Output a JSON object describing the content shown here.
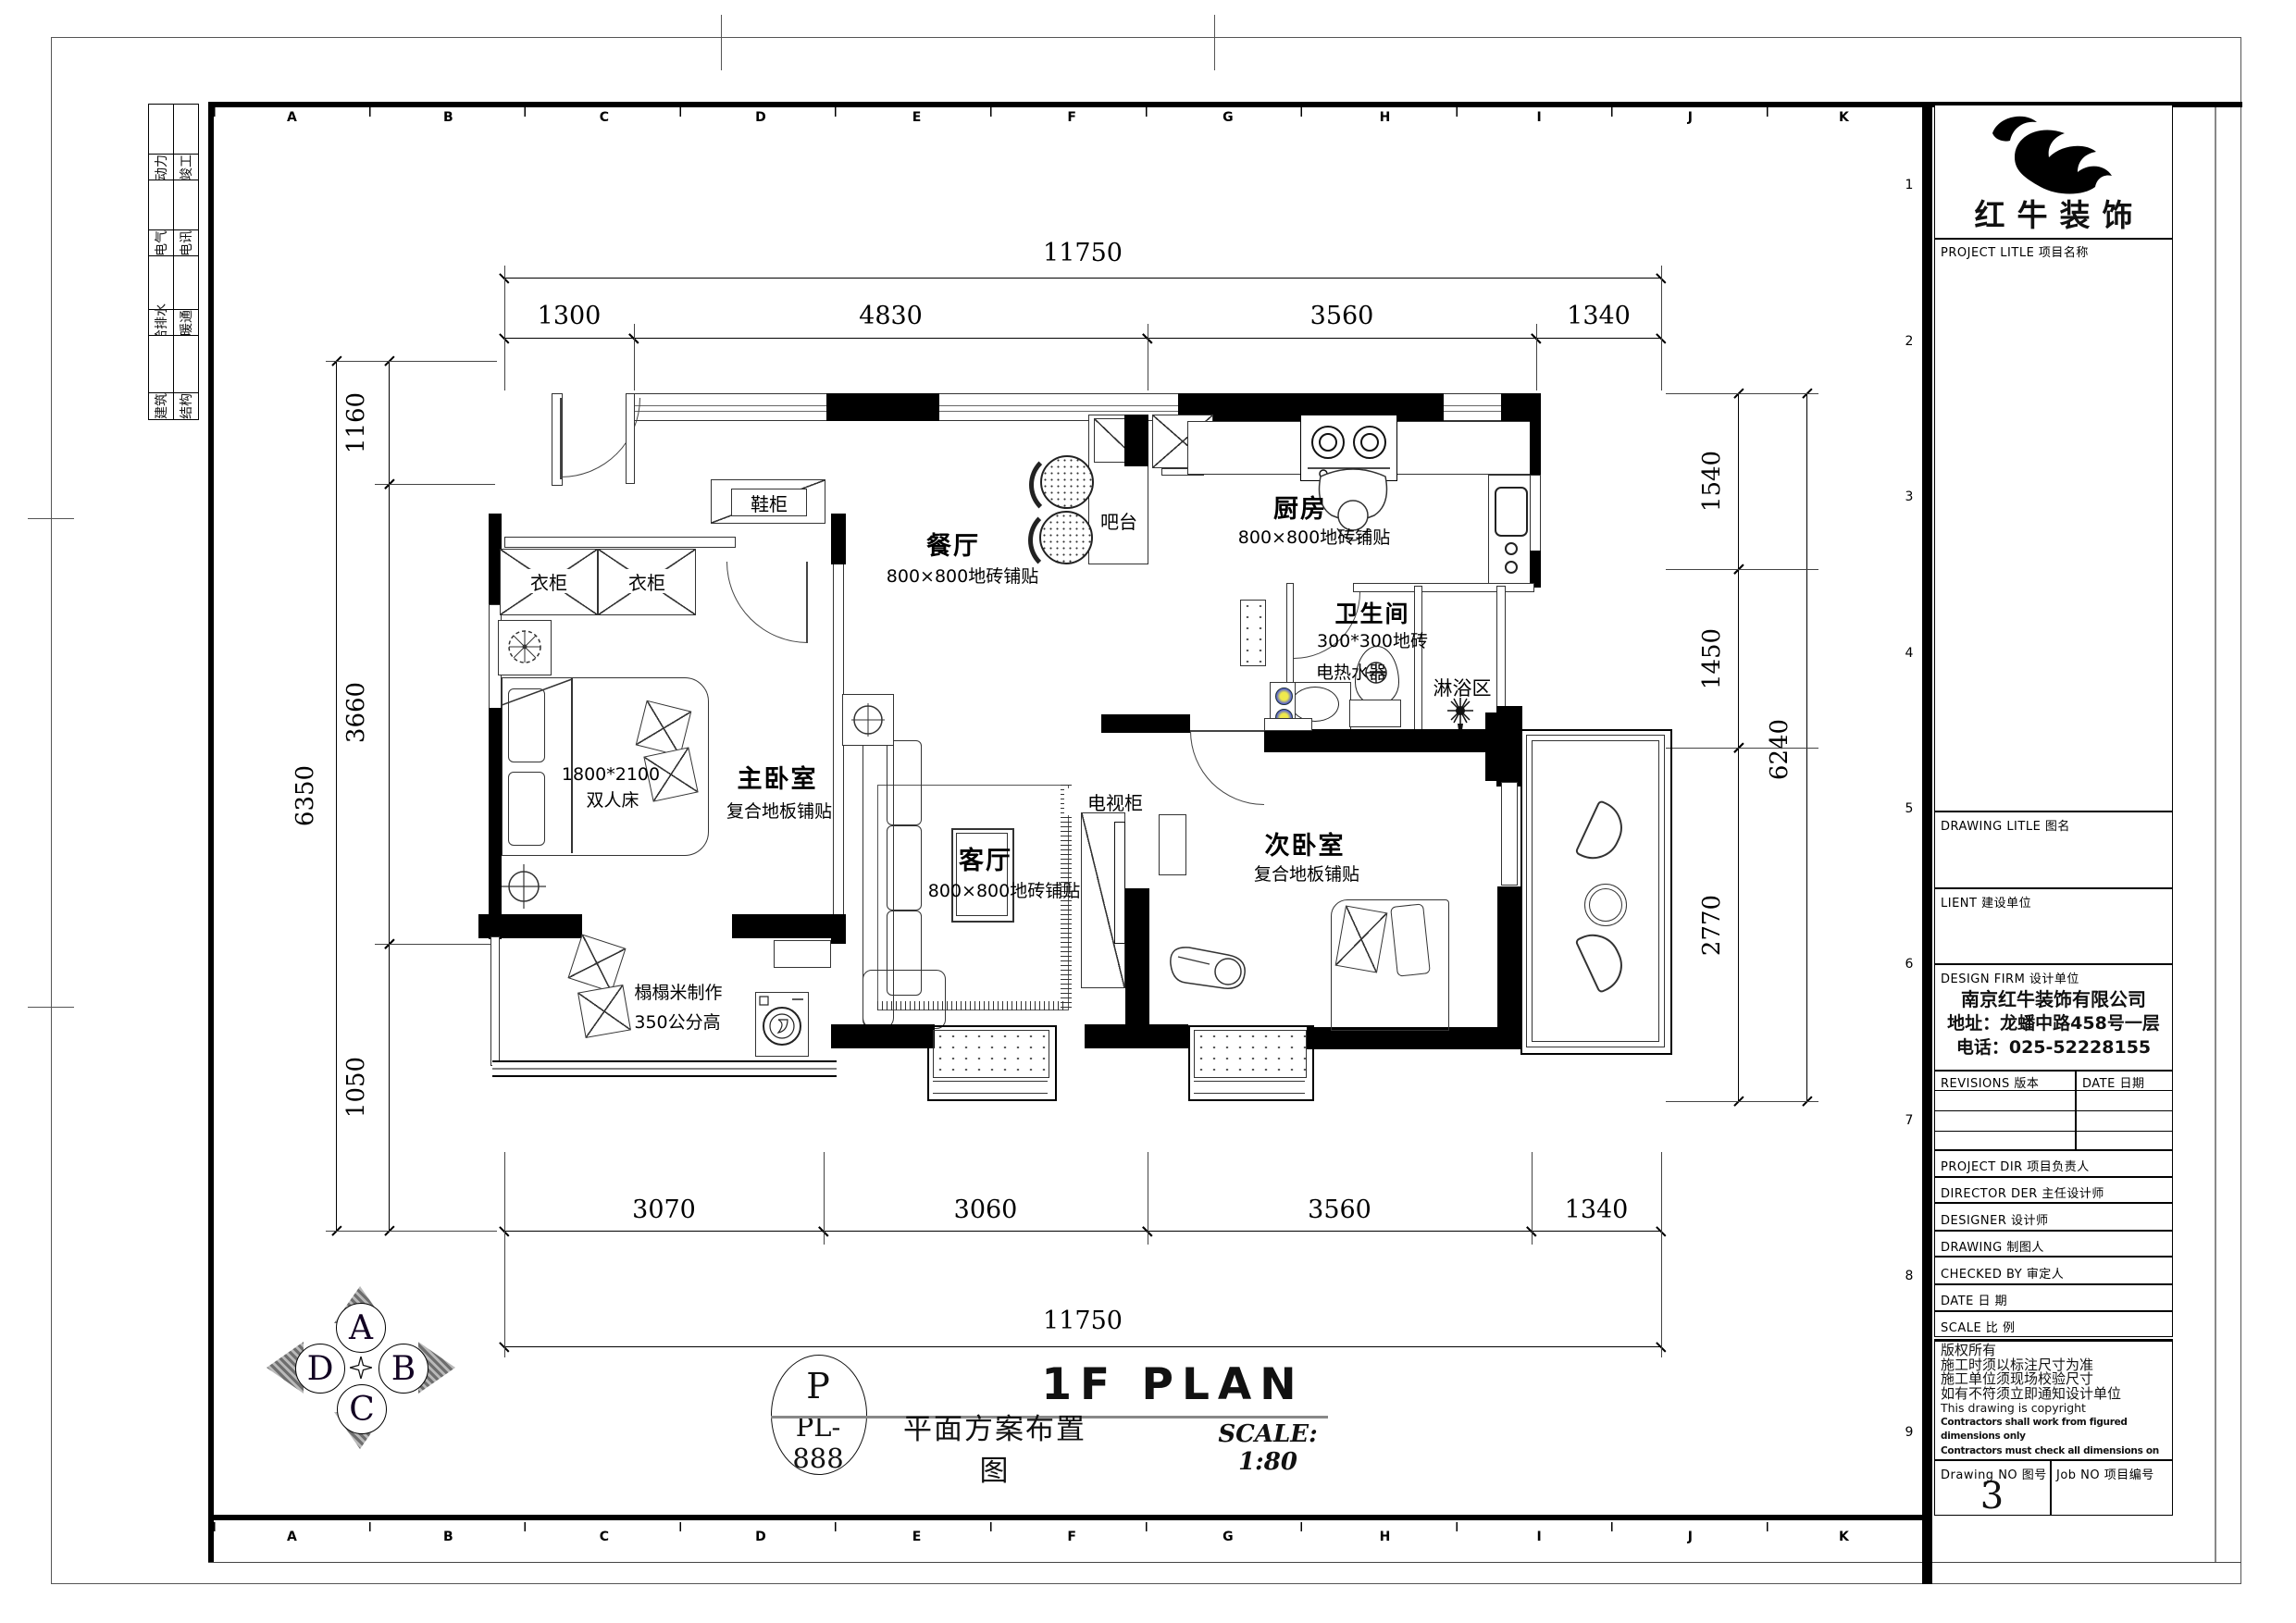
{
  "sheet": {
    "grid_letters": [
      "A",
      "B",
      "C",
      "D",
      "E",
      "F",
      "G",
      "H",
      "I",
      "J",
      "K"
    ],
    "grid_numbers": [
      "1",
      "2",
      "3",
      "4",
      "5",
      "6",
      "7",
      "8",
      "9"
    ],
    "discipline_table": {
      "col1": [
        "动力",
        "电气",
        "给排水",
        "建筑"
      ],
      "col2": [
        "竣工",
        "电讯",
        "暖通",
        "结构"
      ]
    }
  },
  "dimensions": {
    "top": {
      "overall": "11750",
      "segments": [
        "1300",
        "4830",
        "3560",
        "1340"
      ]
    },
    "bottom": {
      "overall": "11750",
      "segments": [
        "3070",
        "3060",
        "3560",
        "1340"
      ]
    },
    "left": {
      "overall": "6350",
      "segments": [
        "1160",
        "3660",
        "1050"
      ]
    },
    "right": {
      "overall": "6240",
      "segments": [
        "1540",
        "1450",
        "2770"
      ]
    }
  },
  "plan": {
    "rooms": {
      "dining": {
        "name": "餐厅",
        "finish": "800×800地砖铺贴"
      },
      "kitchen": {
        "name": "厨房",
        "finish": "800×800地砖铺贴"
      },
      "bathroom": {
        "name": "卫生间",
        "finish": "300*300地砖"
      },
      "shower": {
        "name": "淋浴区"
      },
      "living": {
        "name": "客厅",
        "finish": "800×800地砖铺贴"
      },
      "master_bedroom": {
        "name": "主卧室",
        "finish": "复合地板铺贴"
      },
      "second_bedroom": {
        "name": "次卧室",
        "finish": "复合地板铺贴"
      }
    },
    "items": {
      "shoe_cabinet": "鞋柜",
      "bar": "吧台",
      "wardrobe_left": "衣柜",
      "wardrobe_right": "衣柜",
      "bed_size": "1800*2100",
      "bed_type": "双人床",
      "tv_cabinet": "电视柜",
      "water_heater": "电热水器",
      "tatami_title": "榻榻米制作",
      "tatami_height": "350公分高"
    }
  },
  "title_area": {
    "bubble_letter": "P",
    "bubble_code": "PL-888",
    "title_en": "1F PLAN",
    "title_cn": "平面方案布置图",
    "scale_note": "SCALE: 1:80"
  },
  "compass": {
    "top": "A",
    "right": "B",
    "bottom": "C",
    "left": "D"
  },
  "title_block": {
    "logo_text": "红牛装饰",
    "project_title_label": "PROJECT LITLE 项目名称",
    "drawing_title_label": "DRAWING LITLE 图名",
    "client_label": "LIENT 建设单位",
    "design_firm_label": "DESIGN FIRM 设计单位",
    "design_firm_lines": [
      "南京红牛装饰有限公司",
      "地址：龙蟠中路458号一层",
      "电话：025-52228155"
    ],
    "revisions_label": "REVISIONS 版本",
    "date_col_label": "DATE 日期",
    "project_dir_label": "PROJECT DIR 项目负责人",
    "director_label": "DIRECTOR DER 主任设计师",
    "designer_label": "DESIGNER 设计师",
    "drawing_label": "DRAWING 制图人",
    "checked_label": "CHECKED BY 审定人",
    "date_label": "DATE 日 期",
    "scale_label": "SCALE 比 例",
    "copyright_lines": [
      "版权所有",
      "施工时须以标注尺寸为准",
      "施工单位须现场校验尺寸",
      "如有不符须立即通知设计单位",
      "This drawing is copyright"
    ],
    "copyright_bold_lines": [
      "Contractors shall work from figured dimensions only",
      "Contractors must check all dimensions on site",
      "Contractors must be reported immediately to architects"
    ],
    "drawing_no_label": "Drawing NO 图号",
    "drawing_no": "3",
    "job_no_label": "Job NO 项目编号"
  },
  "colors": {
    "paper": "#ffffff",
    "ink": "#000000",
    "compass_arrow": "#6e6e6e",
    "fixture_dot_inner": "#efe94d",
    "fixture_dot_outer": "#3a4cc0"
  }
}
